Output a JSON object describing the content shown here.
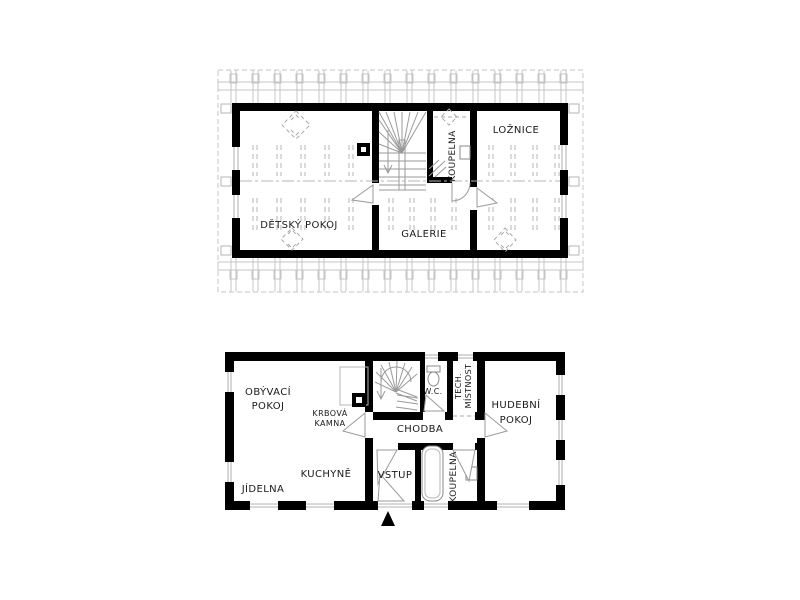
{
  "page": {
    "background": "#ffffff"
  },
  "colors": {
    "wall": "#000000",
    "thin_line": "#9a9a9a",
    "light_line": "#c4c4c4",
    "text": "#1a1a1a"
  },
  "upper_floor": {
    "rooms": {
      "detsky_pokoj": "DĚTSKÝ POKOJ",
      "galerie": "GALERIE",
      "koupelna": "KOUPELNA",
      "loznice": "LOŽNICE"
    }
  },
  "ground_floor": {
    "rooms": {
      "obyvaci_pokoj_line1": "OBÝVACÍ",
      "obyvaci_pokoj_line2": "POKOJ",
      "krbova_kamna_line1": "KRBOVÁ",
      "krbova_kamna_line2": "KAMNA",
      "chodba": "CHODBA",
      "wc": "W.C.",
      "tech_mistnost_line1": "TECH.",
      "tech_mistnost_line2": "MÍSTNOST",
      "hudebni_pokoj_line1": "HUDEBNÍ",
      "hudebni_pokoj_line2": "POKOJ",
      "jidelna": "JÍDELNA",
      "kuchyne": "KUCHYNĚ",
      "vstup": "VSTUP",
      "koupelna": "KOUPELNA"
    }
  }
}
